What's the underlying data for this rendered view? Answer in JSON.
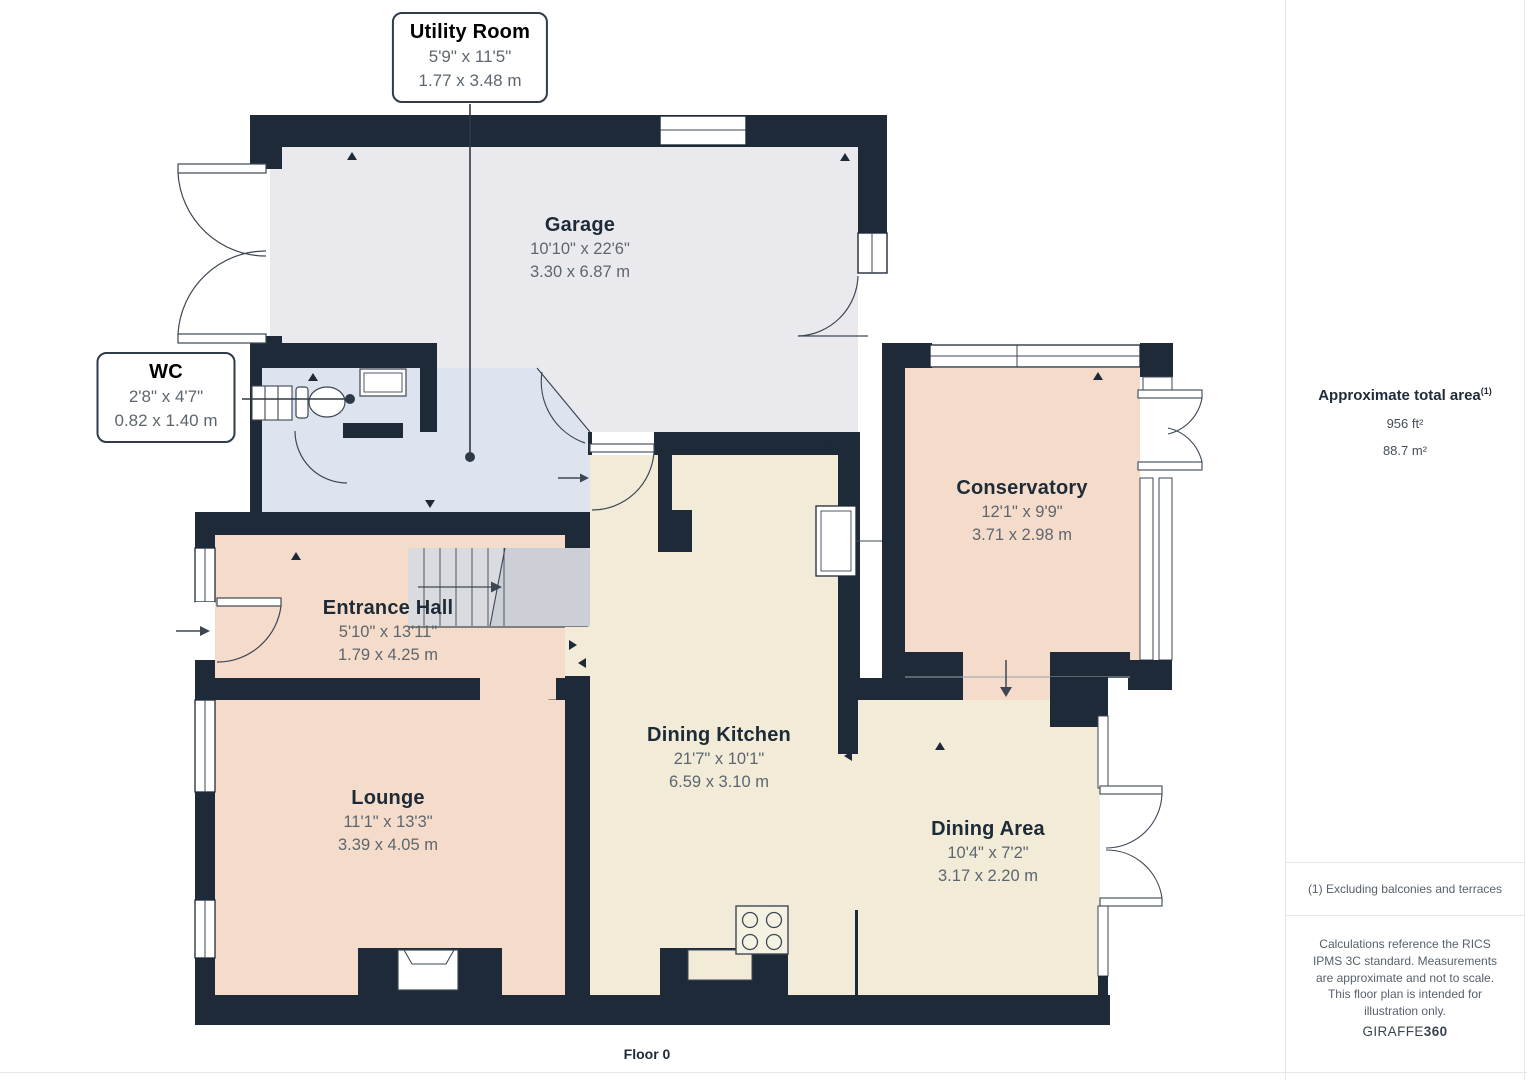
{
  "plan": {
    "floor_label": "Floor 0",
    "rooms": {
      "utility": {
        "name": "Utility Room",
        "imperial": "5'9\" x 11'5\"",
        "metric": "1.77 x 3.48 m"
      },
      "wc": {
        "name": "WC",
        "imperial": "2'8\" x 4'7\"",
        "metric": "0.82 x 1.40 m"
      },
      "garage": {
        "name": "Garage",
        "imperial": "10'10\" x 22'6\"",
        "metric": "3.30 x 6.87 m"
      },
      "conservatory": {
        "name": "Conservatory",
        "imperial": "12'1\" x 9'9\"",
        "metric": "3.71 x 2.98 m"
      },
      "entrance_hall": {
        "name": "Entrance Hall",
        "imperial": "5'10\" x 13'11\"",
        "metric": "1.79 x 4.25 m"
      },
      "lounge": {
        "name": "Lounge",
        "imperial": "11'1\" x 13'3\"",
        "metric": "3.39 x 4.05 m"
      },
      "dining_kitchen": {
        "name": "Dining Kitchen",
        "imperial": "21'7\" x 10'1\"",
        "metric": "6.59 x 3.10 m"
      },
      "dining_area": {
        "name": "Dining Area",
        "imperial": "10'4\" x 7'2\"",
        "metric": "3.17 x 2.20 m"
      }
    },
    "colors": {
      "wall": "#1f2a38",
      "garage_floor": "#eaeaee",
      "hall_floor": "#dee3f0",
      "pink_floor": "#f5dcca",
      "cream_floor": "#f1ebd8",
      "stairs": "#d9dbdf"
    }
  },
  "sidebar": {
    "area_title": "Approximate total area",
    "area_marker": "(1)",
    "area_imperial": "956 ft²",
    "area_metric": "88.7 m²",
    "footnote": "(1) Excluding balconies and terraces",
    "disclaimer": "Calculations reference the RICS IPMS 3C standard. Measurements are approximate and not to scale. This floor plan is intended for illustration only.",
    "brand_name": "GIRAFFE",
    "brand_suffix": "360"
  }
}
